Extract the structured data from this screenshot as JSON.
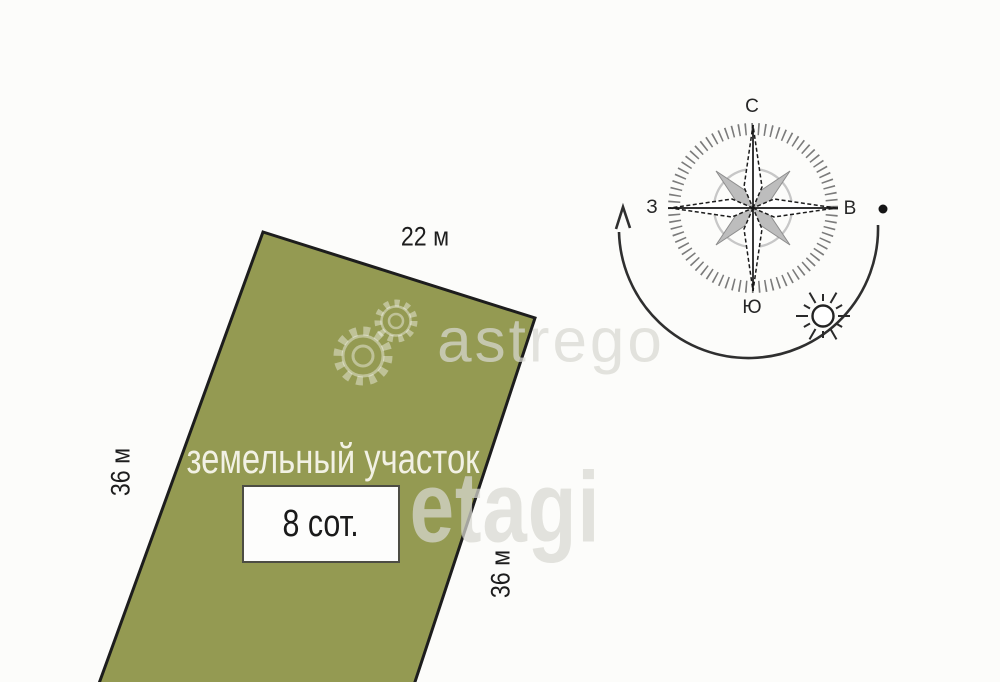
{
  "plot": {
    "label": "земельный участок",
    "area_label": "8 сот.",
    "top_dimension": "22 м",
    "left_dimension": "36 м",
    "right_dimension": "36 м"
  },
  "compass": {
    "north": "С",
    "south": "Ю",
    "west": "З",
    "east": "В"
  },
  "watermarks": {
    "astrego": "astrego",
    "etagi": "etagi"
  },
  "icons": {
    "compass": "compass-rose-icon",
    "sun": "sun-icon",
    "gears": "gear-icon",
    "arrow": "arrow-head-icon"
  },
  "colors": {
    "parcel-fill": "#949a52",
    "parcel-border": "#1d1d1d",
    "label-dark": "#1d1d1d",
    "plot-label-color": "#f2f1e4",
    "watermark-color": "#d9d9d2",
    "compass-dark": "#262626",
    "compass-gray": "#bdbdbd",
    "box-border": "#4d4d44",
    "bg": "#fcfcfa"
  }
}
